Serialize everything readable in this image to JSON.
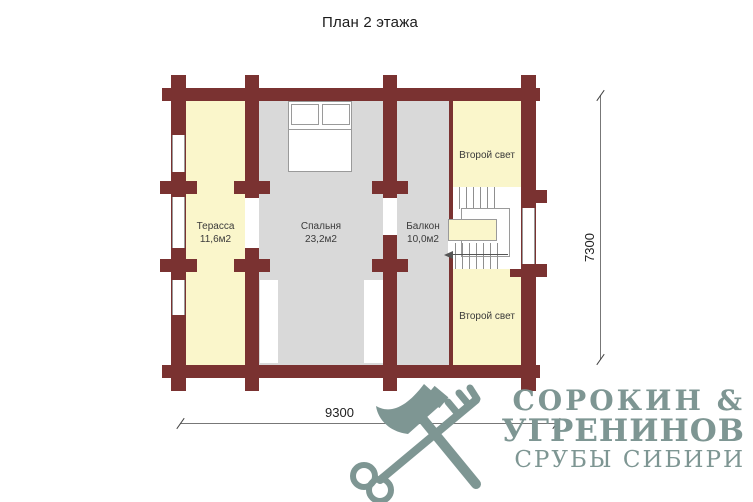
{
  "title": "План 2 этажа",
  "rooms": {
    "terrace": {
      "label": "Терасса",
      "area": "11,6м2"
    },
    "bedroom": {
      "label": "Спальня",
      "area": "23,2м2"
    },
    "balcony": {
      "label": "Балкон",
      "area": "10,0м2"
    },
    "second_light_top": {
      "label": "Второй свет"
    },
    "second_light_bottom": {
      "label": "Второй свет"
    }
  },
  "dimensions": {
    "width_mm": "9300",
    "height_mm": "7300"
  },
  "logo": {
    "name_line1": "СОРОКИН &",
    "name_line2": "УГРЕНИНОВ",
    "tagline": "СРУБЫ СИБИРИ"
  },
  "colors": {
    "wall": "#7a3231",
    "room_yellow": "#faf6cb",
    "room_gray": "#d9d9d9",
    "logo": "#7e9693",
    "text": "#1f1f1f"
  }
}
